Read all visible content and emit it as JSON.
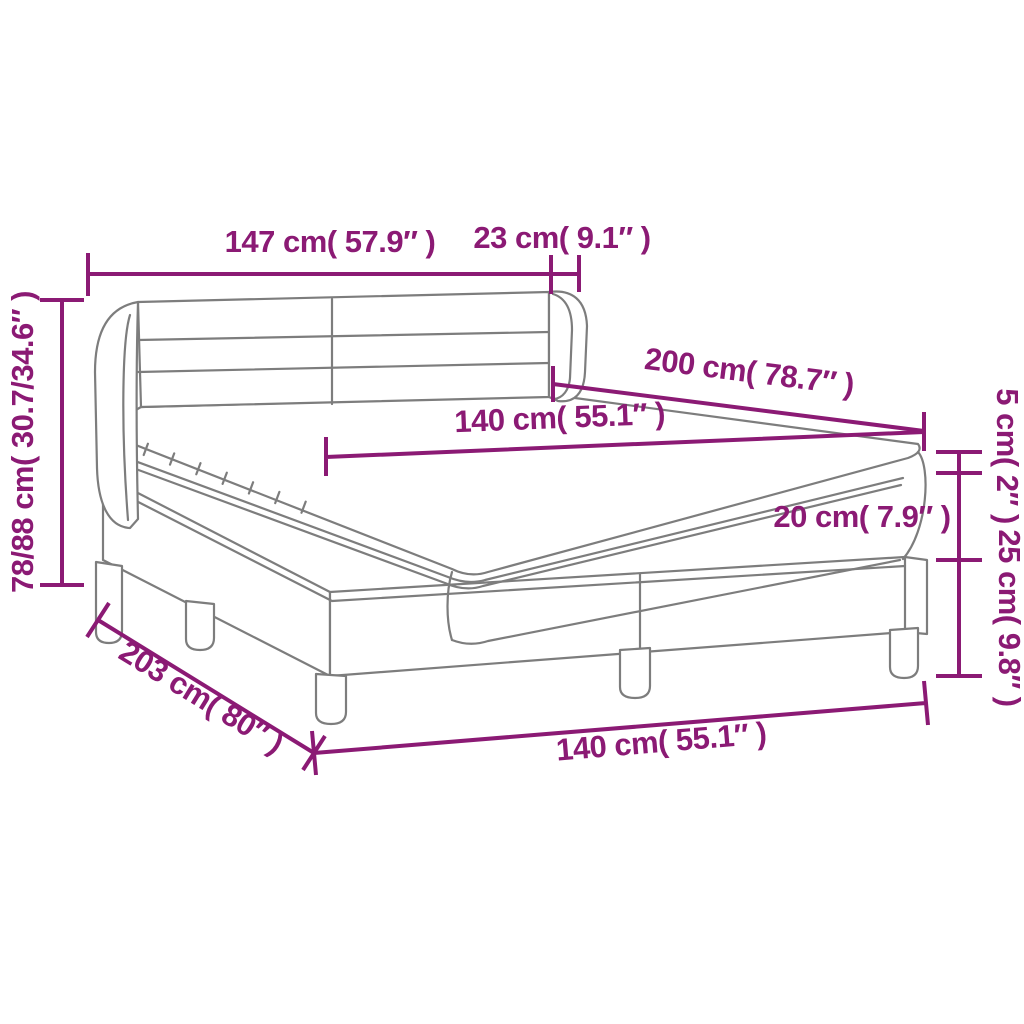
{
  "diagram": {
    "subject": "box-spring-bed-dimension-diagram",
    "colors": {
      "accent": "#8B1A74",
      "outline_gray": "#7D7D7D",
      "background": "#FFFFFF"
    },
    "dimensions": {
      "headboard_width": "147 cm( 57.9″ )",
      "headboard_side_depth": "23 cm( 9.1″ )",
      "total_height": "78/88 cm( 30.7/34.6″ )",
      "bed_length": "200 cm( 78.7″ )",
      "mattress_width_top": "140 cm( 55.1″ )",
      "topper_thickness": "5 cm( 2″ )",
      "mattress_thickness": "20 cm( 7.9″ )",
      "base_height": "25 cm( 9.8″ )",
      "base_length": "203 cm( 80″ )",
      "base_width": "140 cm( 55.1″ )"
    }
  }
}
